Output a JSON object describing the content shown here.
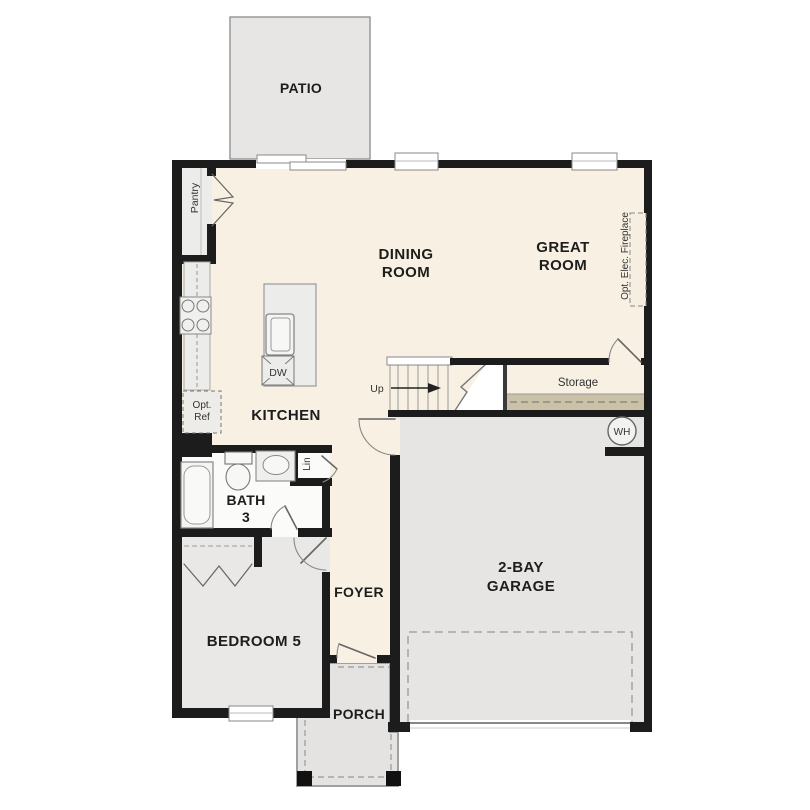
{
  "colors": {
    "floor_cream": "#f8f0e2",
    "room_gray": "#e8e7e5",
    "garage_gray": "#e6e5e3",
    "bath_white": "#fbfbfa",
    "porch_gray": "#e4e3e1",
    "tan_strip": "#cbc1a6",
    "wall_black": "#1c1c1c",
    "outline_gray": "#999999"
  },
  "rooms": {
    "patio": {
      "label": "PATIO"
    },
    "dining": {
      "line1": "DINING",
      "line2": "ROOM"
    },
    "great": {
      "line1": "GREAT",
      "line2": "ROOM"
    },
    "kitchen": {
      "label": "KITCHEN"
    },
    "bath": {
      "line1": "BATH",
      "line2": "3"
    },
    "bedroom": {
      "label": "BEDROOM 5"
    },
    "foyer": {
      "label": "FOYER"
    },
    "garage": {
      "line1": "2-BAY",
      "line2": "GARAGE"
    },
    "porch": {
      "label": "PORCH"
    },
    "storage": {
      "label": "Storage"
    },
    "pantry": {
      "label": "Pantry"
    }
  },
  "annotations": {
    "up": "Up",
    "dw": "DW",
    "wh": "WH",
    "lin": "Lin",
    "opt_ref_line1": "Opt.",
    "opt_ref_line2": "Ref",
    "fireplace": "Opt. Elec. Fireplace"
  }
}
